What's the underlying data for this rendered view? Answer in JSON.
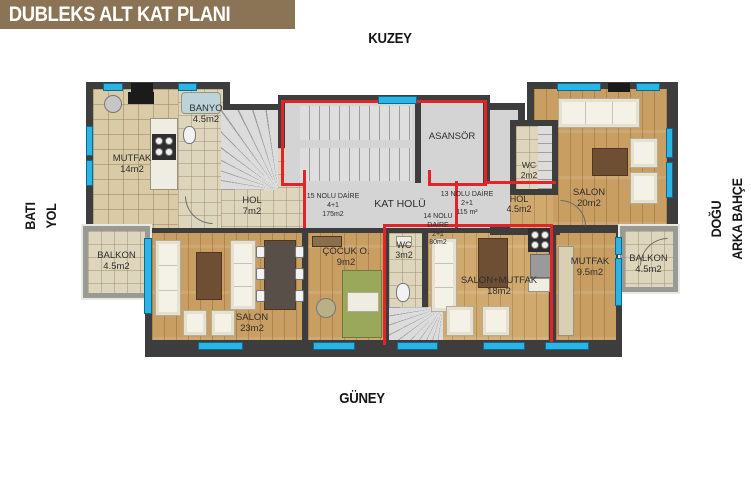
{
  "plan": {
    "title": "DUBLEKS ALT KAT PLANI",
    "compass": {
      "north": "KUZEY",
      "south": "GÜNEY",
      "west": {
        "line1": "BATI",
        "line2": "YOL"
      },
      "east": {
        "line1": "DOĞU",
        "line2": "ARKA BAHÇE"
      }
    },
    "apartments": {
      "apt15": {
        "line1": "15 NOLU DAİRE",
        "line2": "4+1",
        "line3": "175m2"
      },
      "apt13": {
        "line1": "13 NOLU DAİRE",
        "line2": "2+1",
        "line3": "115 m²"
      },
      "apt14": {
        "line1": "14 NOLU",
        "line2": "DAİRE",
        "line3": "2+1",
        "line4": "80m2"
      }
    },
    "rooms": {
      "mutfak14": {
        "name": "MUTFAK",
        "area": "14m2"
      },
      "banyo": {
        "name": "BANYO",
        "area": "4.5m2"
      },
      "hol7": {
        "name": "HOL",
        "area": "7m2"
      },
      "asansor": {
        "name": "ASANSÖR"
      },
      "kat_holu": {
        "name": "KAT HOLÜ"
      },
      "wc2": {
        "name": "WC",
        "area": "2m2"
      },
      "hol45": {
        "name": "HOL",
        "area": "4.5m2"
      },
      "salon20": {
        "name": "SALON",
        "area": "20m2"
      },
      "balkon_left": {
        "name": "BALKON",
        "area": "4.5m2"
      },
      "salon23": {
        "name": "SALON",
        "area": "23m2"
      },
      "cocuk": {
        "name": "ÇOCUK O.",
        "area": "9m2"
      },
      "wc3": {
        "name": "WC",
        "area": "3m2"
      },
      "salon_mutfak": {
        "name": "SALON+MUTFAK",
        "area": "18m2"
      },
      "mutfak95": {
        "name": "MUTFAK",
        "area": "9.5m2"
      },
      "balkon_right": {
        "name": "BALKON",
        "area": "4.5m2"
      }
    },
    "colors": {
      "wall": "#3d3d3d",
      "window": "#2bb5e6",
      "apartment_boundary": "#e2242a",
      "wood_floor": "#c89e63",
      "tile_floor": "#ded5bd",
      "stair_gray": "#d6d6d6",
      "title_bar_bg": "#8b7355",
      "title_text": "#ffffff"
    }
  }
}
